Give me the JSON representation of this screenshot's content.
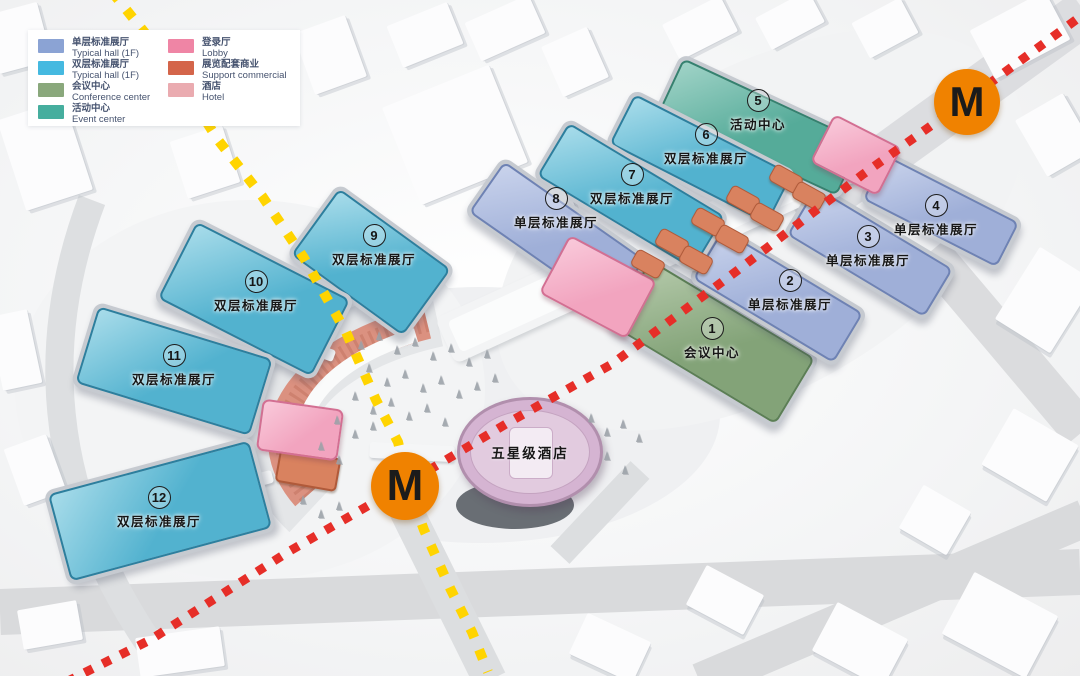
{
  "legend": {
    "items": [
      {
        "zh": "单层标准展厅",
        "en": "Typical hall (1F)",
        "color": "#8ba3d4",
        "key": "single"
      },
      {
        "zh": "双层标准展厅",
        "en": "Typical hall (1F)",
        "color": "#45b9e0",
        "key": "double"
      },
      {
        "zh": "会议中心",
        "en": "Conference center",
        "color": "#8aa87c",
        "key": "conference"
      },
      {
        "zh": "活动中心",
        "en": "Event center",
        "color": "#46ae9e",
        "key": "event"
      },
      {
        "zh": "登录厅",
        "en": "Lobby",
        "color": "#ef85a5",
        "key": "lobby"
      },
      {
        "zh": "展览配套商业",
        "en": "Support commercial",
        "color": "#d4654a",
        "key": "commercial"
      },
      {
        "zh": "酒店",
        "en": "Hotel",
        "color": "#eaabb0",
        "key": "hotel"
      }
    ]
  },
  "map": {
    "halls": [
      {
        "num": "1",
        "name": "会议中心",
        "type": "conference"
      },
      {
        "num": "2",
        "name": "单层标准展厅",
        "type": "single"
      },
      {
        "num": "3",
        "name": "单层标准展厅",
        "type": "single"
      },
      {
        "num": "4",
        "name": "单层标准展厅",
        "type": "single"
      },
      {
        "num": "5",
        "name": "活动中心",
        "type": "event"
      },
      {
        "num": "6",
        "name": "双层标准展厅",
        "type": "double"
      },
      {
        "num": "7",
        "name": "双层标准展厅",
        "type": "double"
      },
      {
        "num": "8",
        "name": "单层标准展厅",
        "type": "single"
      },
      {
        "num": "9",
        "name": "双层标准展厅",
        "type": "double"
      },
      {
        "num": "10",
        "name": "双层标准展厅",
        "type": "double"
      },
      {
        "num": "11",
        "name": "双层标准展厅",
        "type": "double"
      },
      {
        "num": "12",
        "name": "双层标准展厅",
        "type": "double"
      }
    ],
    "hotel": {
      "label": "五星级酒店"
    },
    "metro_stations": [
      {
        "label": "M"
      },
      {
        "label": "M"
      }
    ],
    "colors": {
      "building_single": "#9fafd8",
      "building_double": "#52b2cf",
      "building_conference": "#83a378",
      "building_event": "#55ab99",
      "building_lobby": "#f2a4bf",
      "building_commercial": "#d9825f",
      "building_hotel": "#d5b4d2",
      "metro_marker": "#f08200",
      "metro_line": "#e62e28",
      "pedestrian_line": "#ffd400"
    }
  }
}
